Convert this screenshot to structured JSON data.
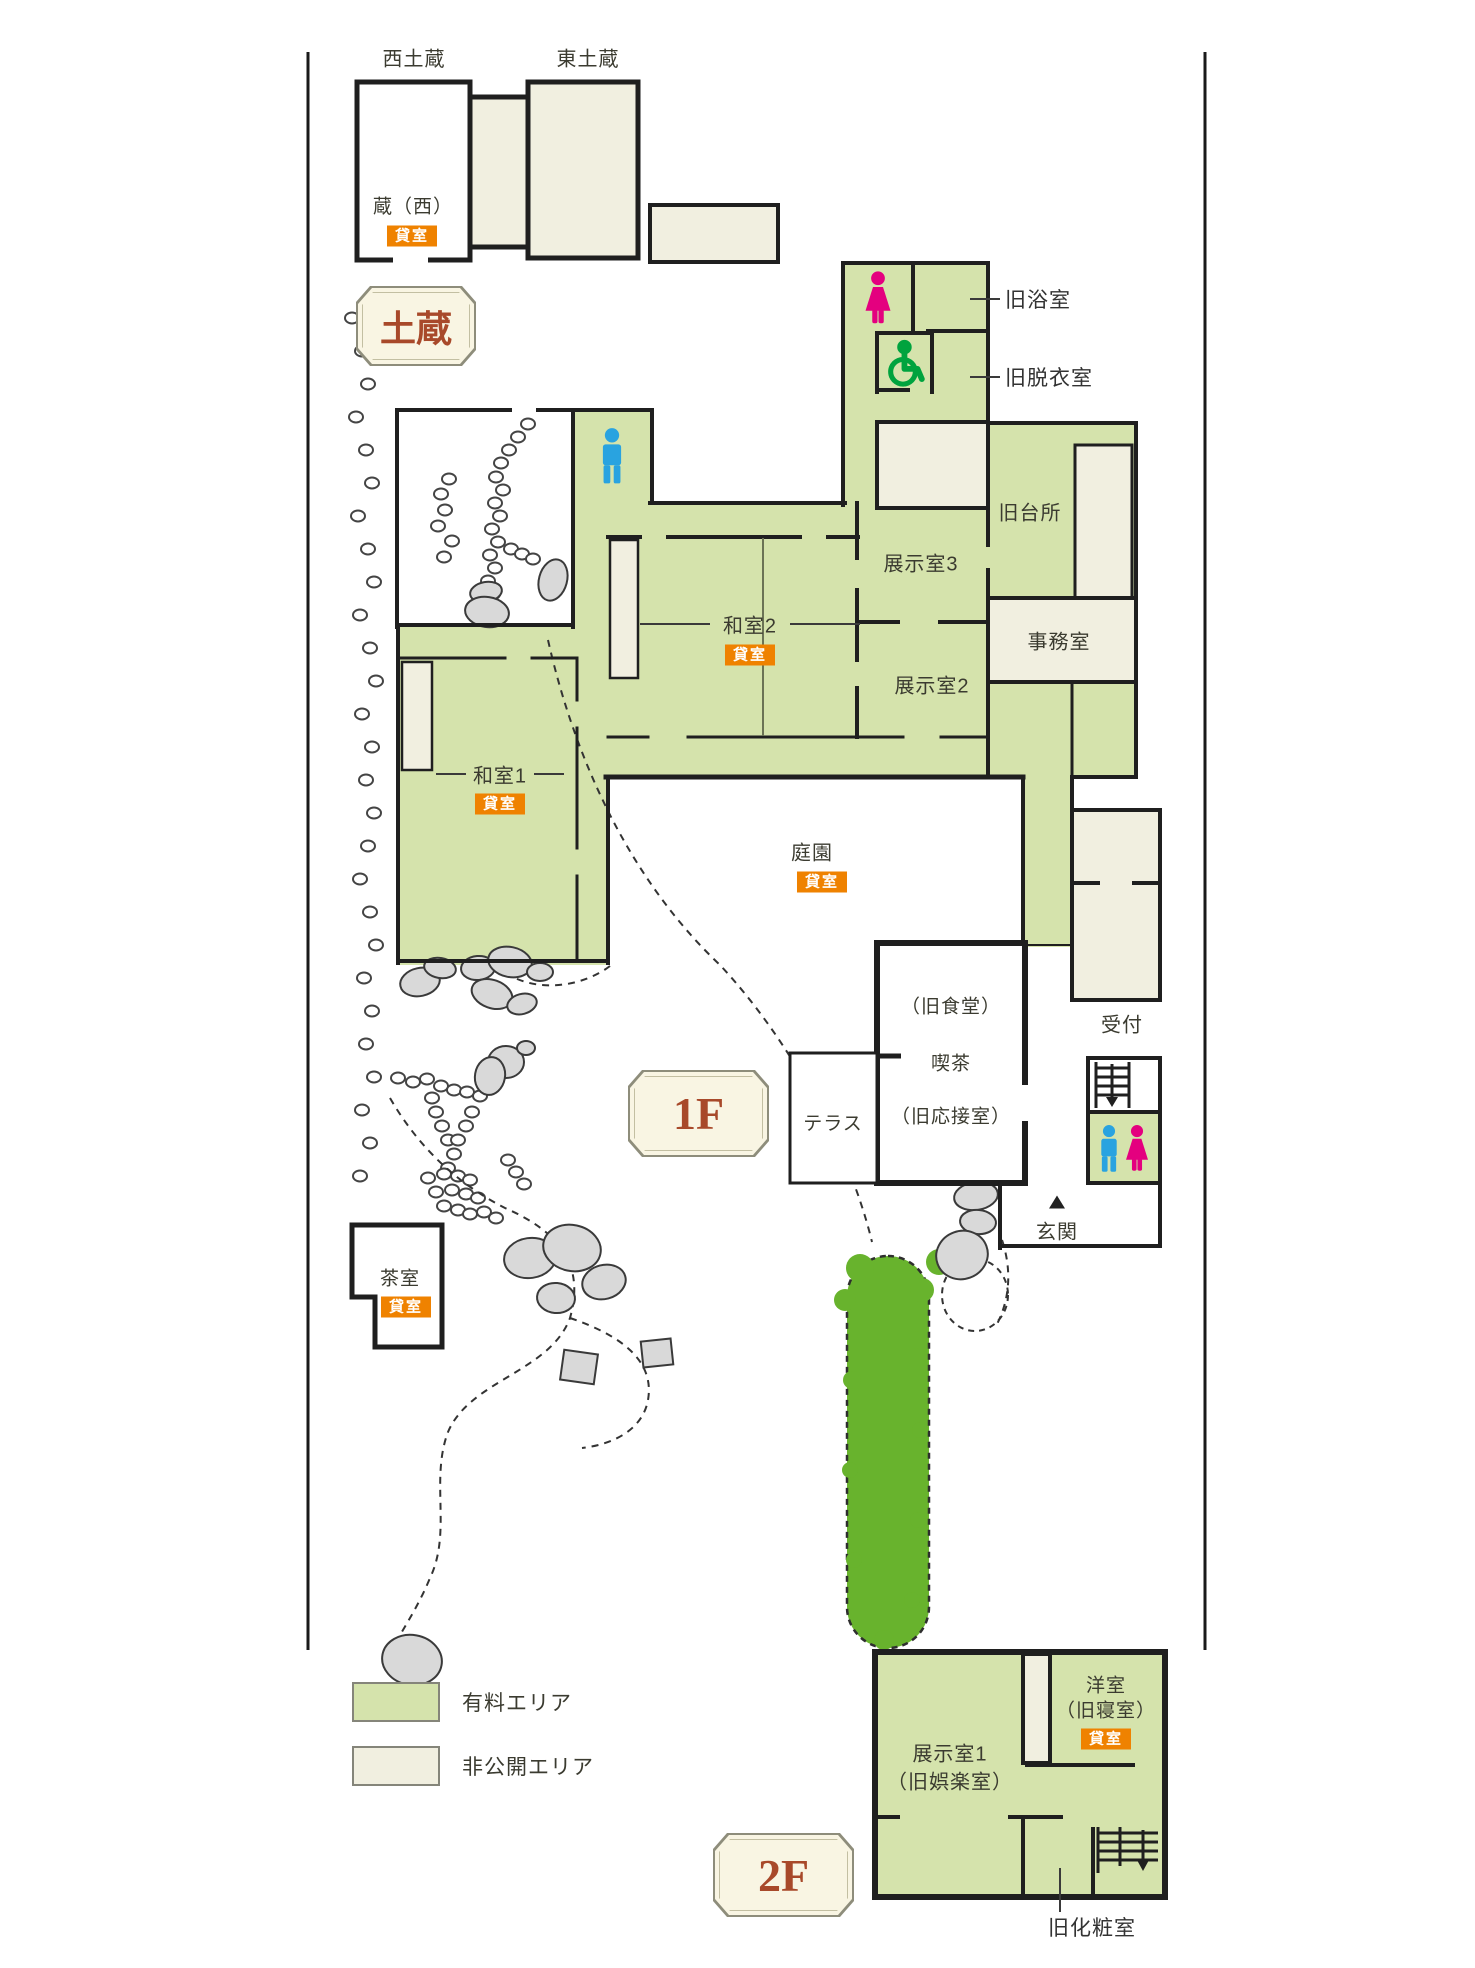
{
  "colors": {
    "paid_area": "#d5e3ac",
    "private_area": "#f1efe0",
    "wall": "#1f1f1f",
    "rental_badge_bg": "#ef8200",
    "floor_badge_text": "#a8492a",
    "man_icon": "#29a3e0",
    "woman_icon": "#e4007f",
    "wheelchair_icon": "#00a33e",
    "rock_fill": "#d9d9d9",
    "tree_fill": "#68b32d"
  },
  "badges": {
    "kura": "土蔵",
    "floor1": "1F",
    "floor2": "2F",
    "rental": "貸室"
  },
  "legend": {
    "paid_label": "有料エリア",
    "private_label": "非公開エリア"
  },
  "kura": {
    "west_title": "西土蔵",
    "east_title": "東土蔵",
    "west_room": "蔵（西）"
  },
  "floor1": {
    "rooms": {
      "bath": "旧浴室",
      "dressing": "旧脱衣室",
      "kitchen": "旧台所",
      "exhibit3": "展示室3",
      "office": "事務室",
      "exhibit2": "展示室2",
      "washitsu2": "和室2",
      "washitsu1": "和室1",
      "garden": "庭園",
      "terrace": "テラス",
      "cafe1": "（旧食堂）",
      "cafe2": "喫茶",
      "cafe3": "（旧応接室）",
      "reception": "受付",
      "entrance": "玄関",
      "tearoom": "茶室"
    }
  },
  "floor2": {
    "rooms": {
      "exhibit1a": "展示室1",
      "exhibit1b": "（旧娯楽室）",
      "western_room_a": "洋室",
      "western_room_b": "（旧寝室）",
      "powder": "旧化粧室"
    }
  },
  "garden": {
    "stepping_stones_left": [
      [
        352,
        318
      ],
      [
        362,
        351
      ],
      [
        368,
        384
      ],
      [
        356,
        417
      ],
      [
        366,
        450
      ],
      [
        372,
        483
      ],
      [
        358,
        516
      ],
      [
        368,
        549
      ],
      [
        374,
        582
      ],
      [
        360,
        615
      ],
      [
        370,
        648
      ],
      [
        376,
        681
      ],
      [
        362,
        714
      ],
      [
        372,
        747
      ],
      [
        366,
        780
      ],
      [
        374,
        813
      ],
      [
        368,
        846
      ],
      [
        360,
        879
      ],
      [
        370,
        912
      ],
      [
        376,
        945
      ],
      [
        364,
        978
      ],
      [
        372,
        1011
      ],
      [
        366,
        1044
      ],
      [
        374,
        1077
      ],
      [
        362,
        1110
      ],
      [
        370,
        1143
      ],
      [
        360,
        1176
      ]
    ],
    "stepping_stones_courtyard": [
      [
        528,
        424
      ],
      [
        518,
        437
      ],
      [
        509,
        450
      ],
      [
        501,
        463
      ],
      [
        496,
        477
      ],
      [
        503,
        490
      ],
      [
        495,
        503
      ],
      [
        500,
        516
      ],
      [
        492,
        529
      ],
      [
        498,
        542
      ],
      [
        490,
        555
      ],
      [
        495,
        568
      ],
      [
        488,
        581
      ],
      [
        493,
        594
      ],
      [
        449,
        479
      ],
      [
        441,
        494
      ],
      [
        445,
        510
      ],
      [
        438,
        526
      ],
      [
        452,
        541
      ],
      [
        444,
        557
      ],
      [
        511,
        549
      ],
      [
        522,
        554
      ],
      [
        533,
        559
      ]
    ],
    "stepping_stones_path": [
      [
        398,
        1078
      ],
      [
        413,
        1082
      ],
      [
        427,
        1079
      ],
      [
        441,
        1086
      ],
      [
        454,
        1090
      ],
      [
        467,
        1092
      ],
      [
        480,
        1096
      ],
      [
        432,
        1098
      ],
      [
        436,
        1112
      ],
      [
        442,
        1126
      ],
      [
        448,
        1140
      ],
      [
        454,
        1154
      ],
      [
        448,
        1168
      ],
      [
        472,
        1112
      ],
      [
        466,
        1126
      ],
      [
        458,
        1140
      ],
      [
        428,
        1178
      ],
      [
        444,
        1174
      ],
      [
        458,
        1176
      ],
      [
        470,
        1180
      ],
      [
        436,
        1192
      ],
      [
        452,
        1190
      ],
      [
        466,
        1194
      ],
      [
        478,
        1198
      ],
      [
        444,
        1206
      ],
      [
        458,
        1210
      ],
      [
        470,
        1214
      ],
      [
        484,
        1212
      ],
      [
        496,
        1218
      ],
      [
        508,
        1160
      ],
      [
        516,
        1172
      ],
      [
        524,
        1184
      ]
    ],
    "rocks": [
      [
        486,
        592,
        16,
        10,
        -10
      ],
      [
        487,
        612,
        22,
        15,
        8
      ],
      [
        553,
        580,
        14,
        21,
        15
      ],
      [
        420,
        982,
        20,
        14,
        -12
      ],
      [
        440,
        968,
        16,
        10,
        10
      ],
      [
        478,
        968,
        17,
        12,
        -5
      ],
      [
        510,
        962,
        22,
        15,
        12
      ],
      [
        540,
        972,
        13,
        9,
        0
      ],
      [
        492,
        994,
        21,
        14,
        20
      ],
      [
        522,
        1004,
        15,
        10,
        -15
      ],
      [
        506,
        1062,
        18,
        16,
        0
      ],
      [
        490,
        1076,
        15,
        19,
        10
      ],
      [
        526,
        1048,
        9,
        7,
        0
      ],
      [
        530,
        1258,
        26,
        20,
        -8
      ],
      [
        572,
        1248,
        29,
        23,
        12
      ],
      [
        604,
        1282,
        22,
        17,
        -15
      ],
      [
        556,
        1298,
        19,
        15,
        5
      ],
      [
        412,
        1660,
        30,
        25,
        10
      ],
      [
        982,
        1165,
        21,
        13,
        5
      ],
      [
        976,
        1196,
        22,
        14,
        -8
      ],
      [
        978,
        1222,
        18,
        12,
        5
      ],
      [
        962,
        1255,
        26,
        24,
        -20
      ]
    ],
    "square_stones": [
      [
        562,
        1352,
        34,
        30,
        8
      ],
      [
        642,
        1340,
        30,
        26,
        -6
      ]
    ],
    "dashed_paths": [
      "M548,640 C575,760 630,880 720,965 C790,1040 850,1150 872,1242",
      "M390,1098 C420,1150 460,1185 505,1208 C560,1232 585,1265 570,1318 C550,1372 470,1380 448,1432 C430,1480 452,1532 430,1578 C416,1612 398,1636 386,1660",
      "M570,1318 C620,1335 655,1360 648,1400 C643,1428 616,1444 582,1448",
      "M1002,1240 C1012,1270 1010,1300 996,1326",
      "M610,966 C585,985 545,992 515,978"
    ],
    "dashed_circle": [
      975,
      1295,
      33,
      36
    ],
    "tree": {
      "x": 847,
      "y": 1256,
      "w": 82,
      "h": 392
    }
  }
}
